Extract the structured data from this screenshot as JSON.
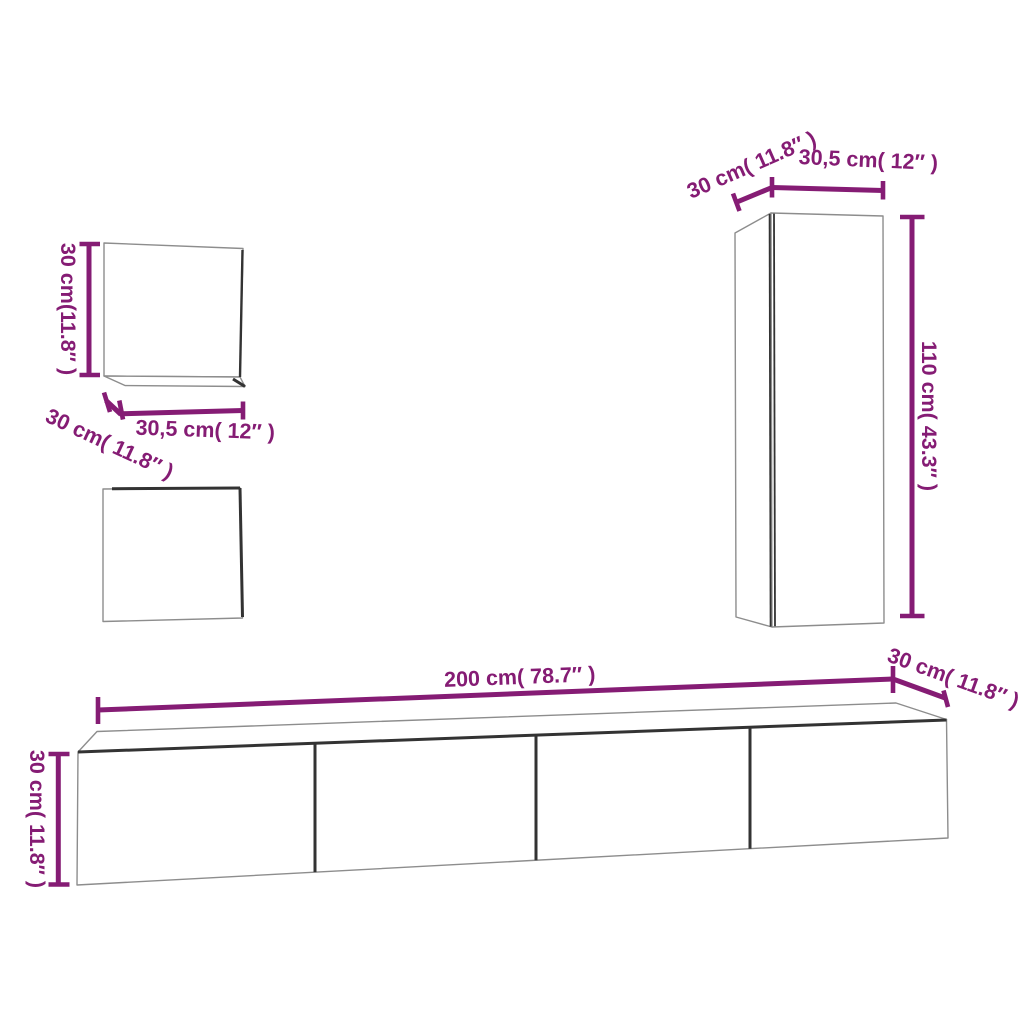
{
  "diagram": {
    "type": "furniture-dimension-diagram",
    "colors": {
      "accent": "#851c74",
      "outline": "#8d8d8d",
      "edge": "#333333",
      "background": "#ffffff"
    },
    "dimensions": {
      "small_cabinet": {
        "height": "30 cm(11.8″ )",
        "depth": "30 cm( 11.8″ )",
        "width": "30,5 cm( 12″ )"
      },
      "tall_cabinet": {
        "depth": "30 cm( 11.8″ )",
        "width": "30,5 cm( 12″ )",
        "height": "110 cm( 43.3″ )"
      },
      "long_cabinet": {
        "length": "200 cm( 78.7″ )",
        "depth": "30 cm( 11.8″ )",
        "height": "30 cm( 11.8″ )"
      }
    }
  }
}
